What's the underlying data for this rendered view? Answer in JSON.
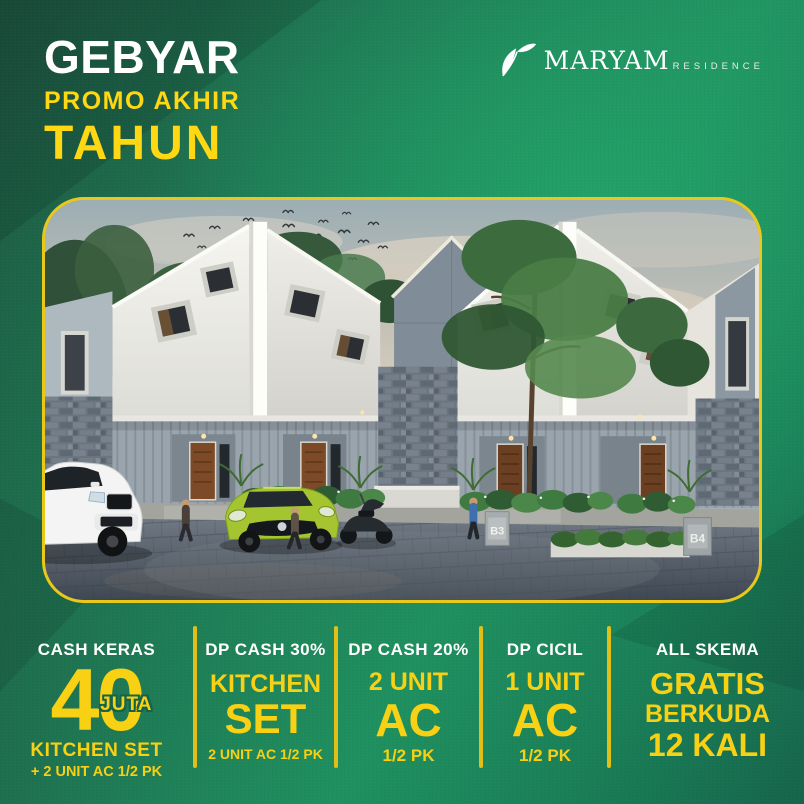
{
  "poster": {
    "title": {
      "line1": "GEBYAR",
      "line2": "PROMO AKHIR",
      "line3": "TAHUN"
    },
    "brand": {
      "name": "MARYAM",
      "type": "RESIDENCE",
      "logo_icon": "leaf-icon"
    },
    "scene": {
      "unit_labels": [
        "B3",
        "B4"
      ]
    },
    "offers": [
      {
        "scheme": "CASH KERAS",
        "value": "40",
        "value_unit": "JUTA",
        "bonus1": "KITCHEN SET",
        "bonus2": "+ 2 UNIT AC 1/2 PK"
      },
      {
        "scheme": "DP CASH 30%",
        "big1": "KITCHEN",
        "big2": "SET",
        "sub": "2 UNIT AC 1/2 PK"
      },
      {
        "scheme": "DP CASH 20%",
        "big1": "2 UNIT",
        "big2": "AC",
        "sub": "1/2 PK"
      },
      {
        "scheme": "DP CICIL",
        "big1": "1 UNIT",
        "big2": "AC",
        "sub": "1/2 PK"
      },
      {
        "scheme": "ALL SKEMA",
        "big1": "GRATIS",
        "big2": "BERKUDA",
        "big3": "12 KALI"
      }
    ],
    "colors": {
      "background_dark_green": "#1c4b3a",
      "background_bright_green": "#1f9a63",
      "accent_yellow": "#f8d014",
      "frame_border_yellow": "#e9c81a",
      "text_white": "#ffffff"
    }
  }
}
